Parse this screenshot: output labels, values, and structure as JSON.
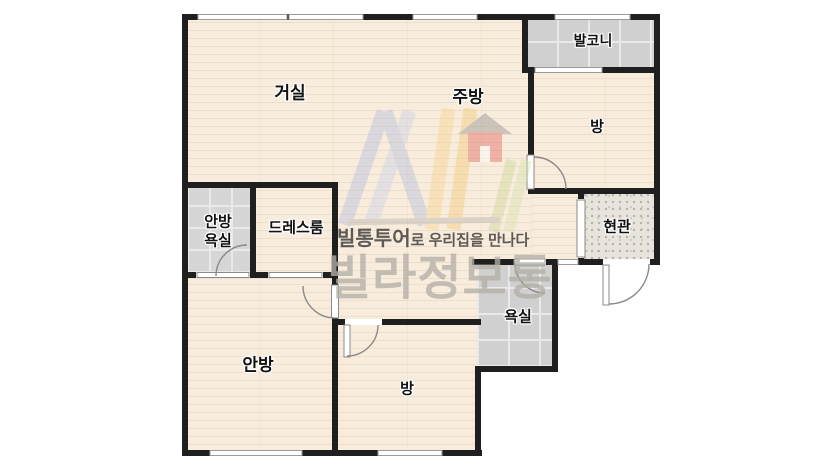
{
  "floorplan": {
    "rooms": {
      "living": {
        "label": "거실"
      },
      "kitchen": {
        "label": "주방"
      },
      "balcony": {
        "label": "발코니"
      },
      "room_top": {
        "label": "방"
      },
      "entrance": {
        "label": "현관"
      },
      "master_bath": {
        "label_line1": "안방",
        "label_line2": "욕실"
      },
      "dressroom": {
        "label": "드레스룸"
      },
      "bath": {
        "label": "욕실"
      },
      "master_bedroom": {
        "label": "안방"
      },
      "room_bottom": {
        "label": "방"
      }
    },
    "watermark": {
      "tagline_brand": "빌통투어",
      "tagline_rest": "로 우리집을 만나다",
      "brand": "빌라정보통"
    },
    "colors": {
      "wall": "#1f1f1f",
      "wood_floor": "#f8ecdd",
      "tile_gray": "#d0d0d0",
      "entry_tile": "#e7e4de",
      "door_stroke": "#8a8a8a",
      "logo_blue": "#b3bedf",
      "logo_blue_light": "#c9d1ea",
      "logo_yellow": "#f6d28e",
      "logo_yellow_dark": "#f3ca74",
      "logo_green": "#c9d794",
      "logo_green_light": "#d7e2ac",
      "logo_red": "#e2625a",
      "logo_roof_gray": "#8f8f8b"
    }
  }
}
